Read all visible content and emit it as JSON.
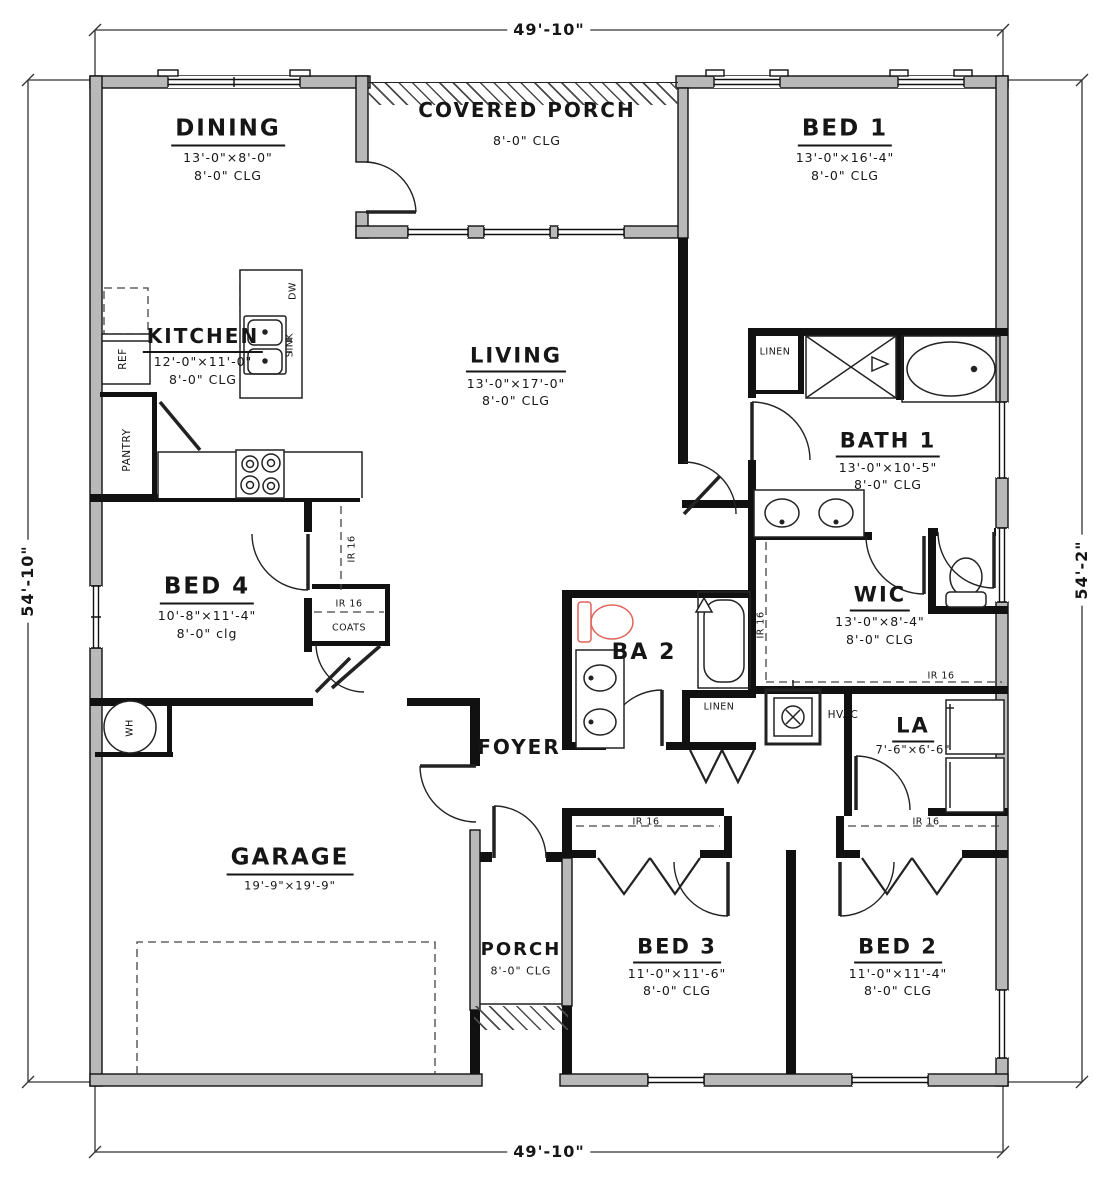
{
  "plan": {
    "dimensions": {
      "top": "49'-10\"",
      "bottom": "49'-10\"",
      "left": "54'-10\"",
      "right": "54'-2\""
    },
    "rooms": {
      "dining": {
        "name": "DINING",
        "size": "13'-0\"×8'-0\"",
        "ceiling": "8'-0\" CLG"
      },
      "covered_porch": {
        "name": "COVERED PORCH",
        "ceiling": "8'-0\" CLG"
      },
      "bed1": {
        "name": "BED 1",
        "size": "13'-0\"×16'-4\"",
        "ceiling": "8'-0\" CLG"
      },
      "kitchen": {
        "name": "KITCHEN",
        "size": "12'-0\"×11'-0\"",
        "ceiling": "8'-0\" CLG"
      },
      "living": {
        "name": "LIVING",
        "size": "13'-0\"×17'-0\"",
        "ceiling": "8'-0\" CLG"
      },
      "bath1": {
        "name": "BATH 1",
        "size": "13'-0\"×10'-5\"",
        "ceiling": "8'-0\" CLG"
      },
      "bed4": {
        "name": "BED 4",
        "size": "10'-8\"×11'-4\"",
        "ceiling": "8'-0\" clg"
      },
      "wic": {
        "name": "WIC",
        "size": "13'-0\"×8'-4\"",
        "ceiling": "8'-0\" CLG"
      },
      "ba2": {
        "name": "BA 2"
      },
      "foyer": {
        "name": "FOYER"
      },
      "la": {
        "name": "LA",
        "size": "7'-6\"×6'-6\""
      },
      "garage": {
        "name": "GARAGE",
        "size": "19'-9\"×19'-9\""
      },
      "porch": {
        "name": "PORCH",
        "ceiling": "8'-0\" CLG"
      },
      "bed3": {
        "name": "BED 3",
        "size": "11'-0\"×11'-6\"",
        "ceiling": "8'-0\" CLG"
      },
      "bed2": {
        "name": "BED 2",
        "size": "11'-0\"×11'-4\"",
        "ceiling": "8'-0\" CLG"
      }
    },
    "fixtures": {
      "linen": "LINEN",
      "coats": "COATS",
      "pantry": "PANTRY",
      "ref": "REF",
      "dw": "DW",
      "sink": "SINK",
      "hvac": "HVAC",
      "wh": "WH",
      "ir16": "IR 16"
    },
    "colors": {
      "interior_wall": "#111111",
      "exterior_wall_fill": "#b9b9b9",
      "line": "#222222",
      "highlight_fixture": "#e0635a"
    }
  }
}
